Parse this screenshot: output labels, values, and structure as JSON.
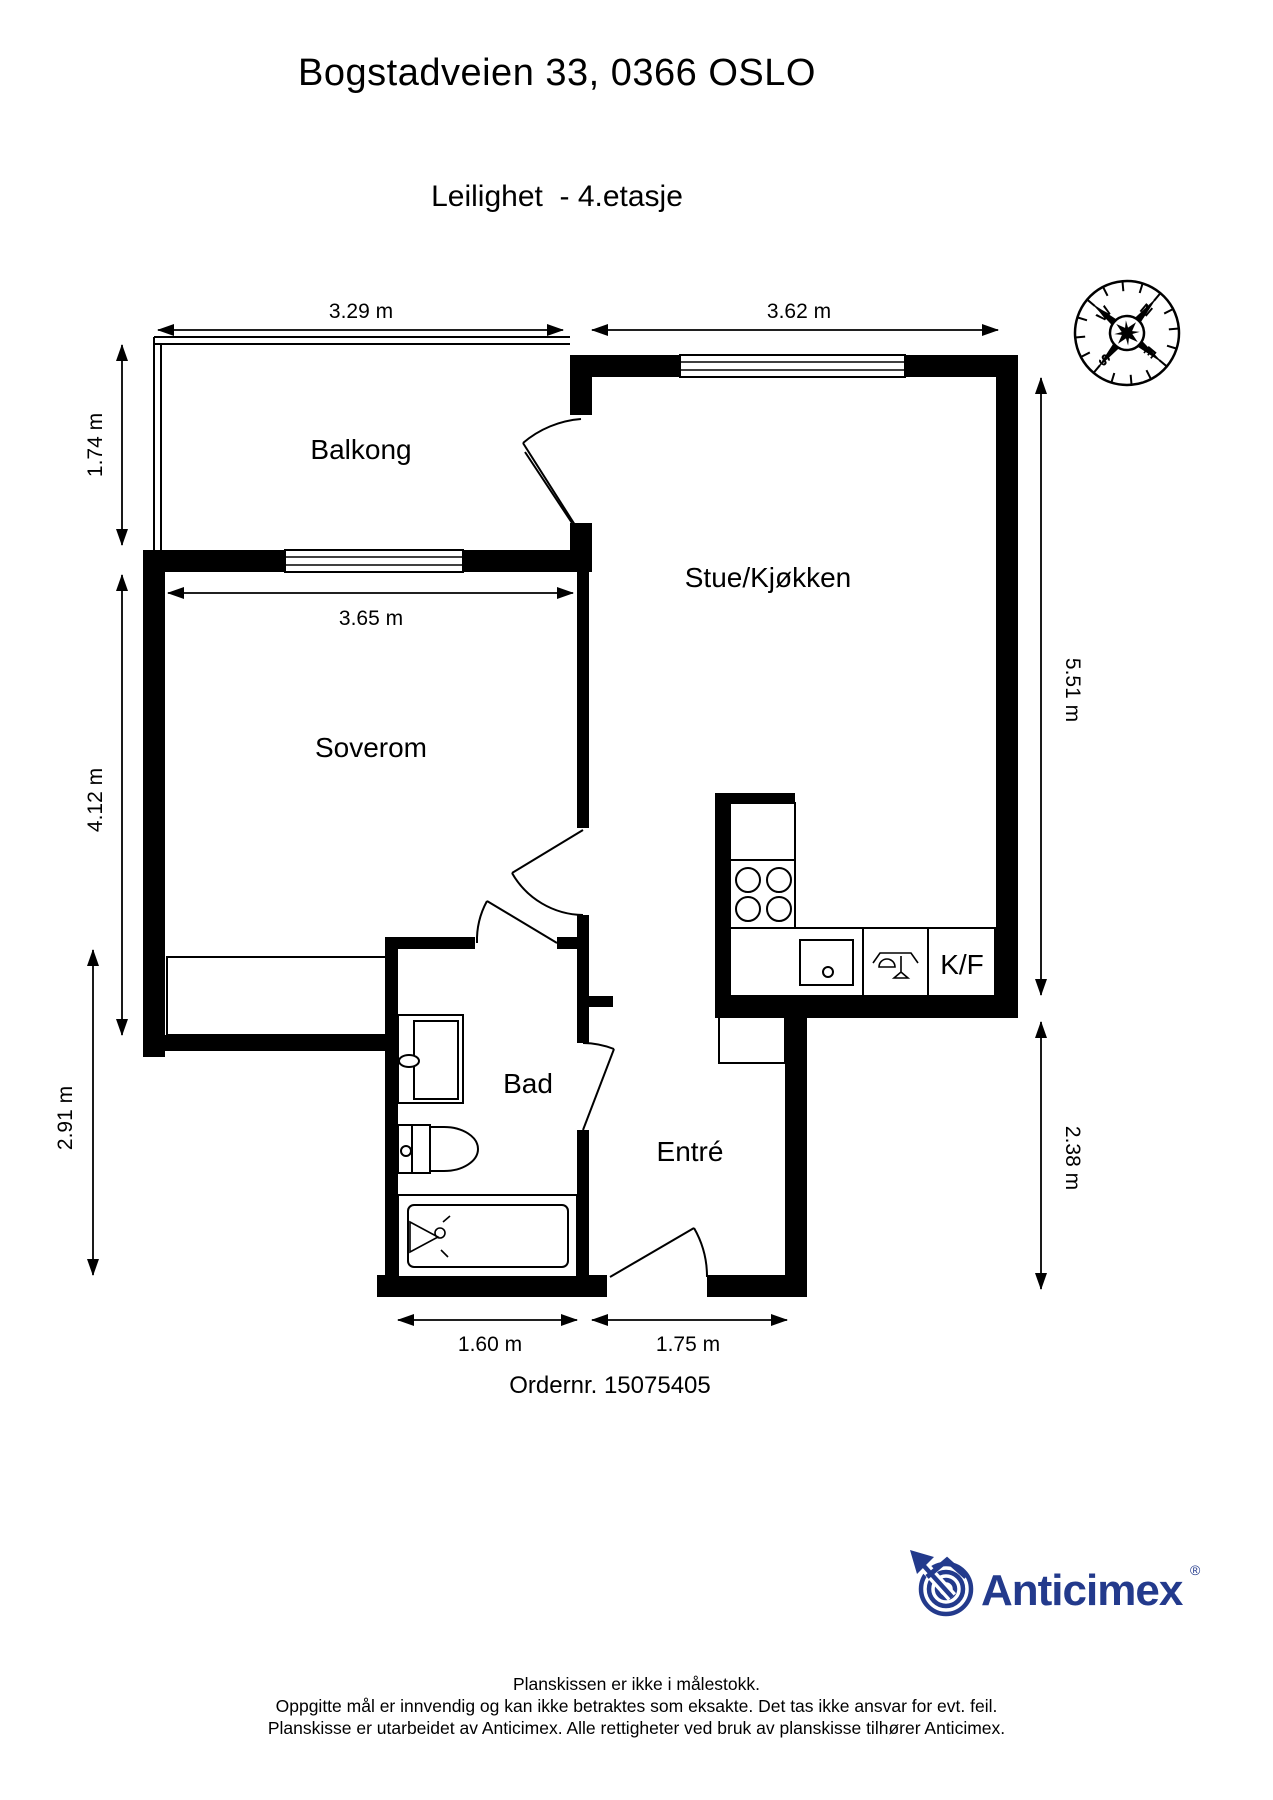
{
  "header": {
    "title": "Bogstadveien 33, 0366 OSLO",
    "subtitle": "Leilighet  - 4.etasje"
  },
  "plan": {
    "rooms": {
      "balcony": "Balkong",
      "living_kitchen": "Stue/Kjøkken",
      "bedroom": "Soverom",
      "bathroom": "Bad",
      "entry": "Entré",
      "fridge_freezer": "K/F"
    },
    "dimensions": {
      "balcony_width": "3.29 m",
      "living_width": "3.62 m",
      "balcony_depth": "1.74 m",
      "bedroom_width": "3.65 m",
      "bedroom_depth": "4.12 m",
      "bath_depth": "2.91 m",
      "living_depth": "5.51 m",
      "entry_depth": "2.38 m",
      "bath_width": "1.60 m",
      "entry_width": "1.75 m"
    },
    "compass": {
      "north": "N",
      "east": "E",
      "south": "S",
      "west": "W"
    }
  },
  "order_number": "Ordernr. 15075405",
  "brand": {
    "name": "Anticimex",
    "registered_mark": "®",
    "color": "#233a8c"
  },
  "footer": {
    "line1": "Planskissen er ikke i målestokk.",
    "line2": "Oppgitte mål er innvendig og kan ikke betraktes som eksakte. Det tas ikke ansvar for evt. feil.",
    "line3": "Planskisse er utarbeidet av Anticimex. Alle rettigheter ved bruk av planskisse tilhører Anticimex."
  }
}
